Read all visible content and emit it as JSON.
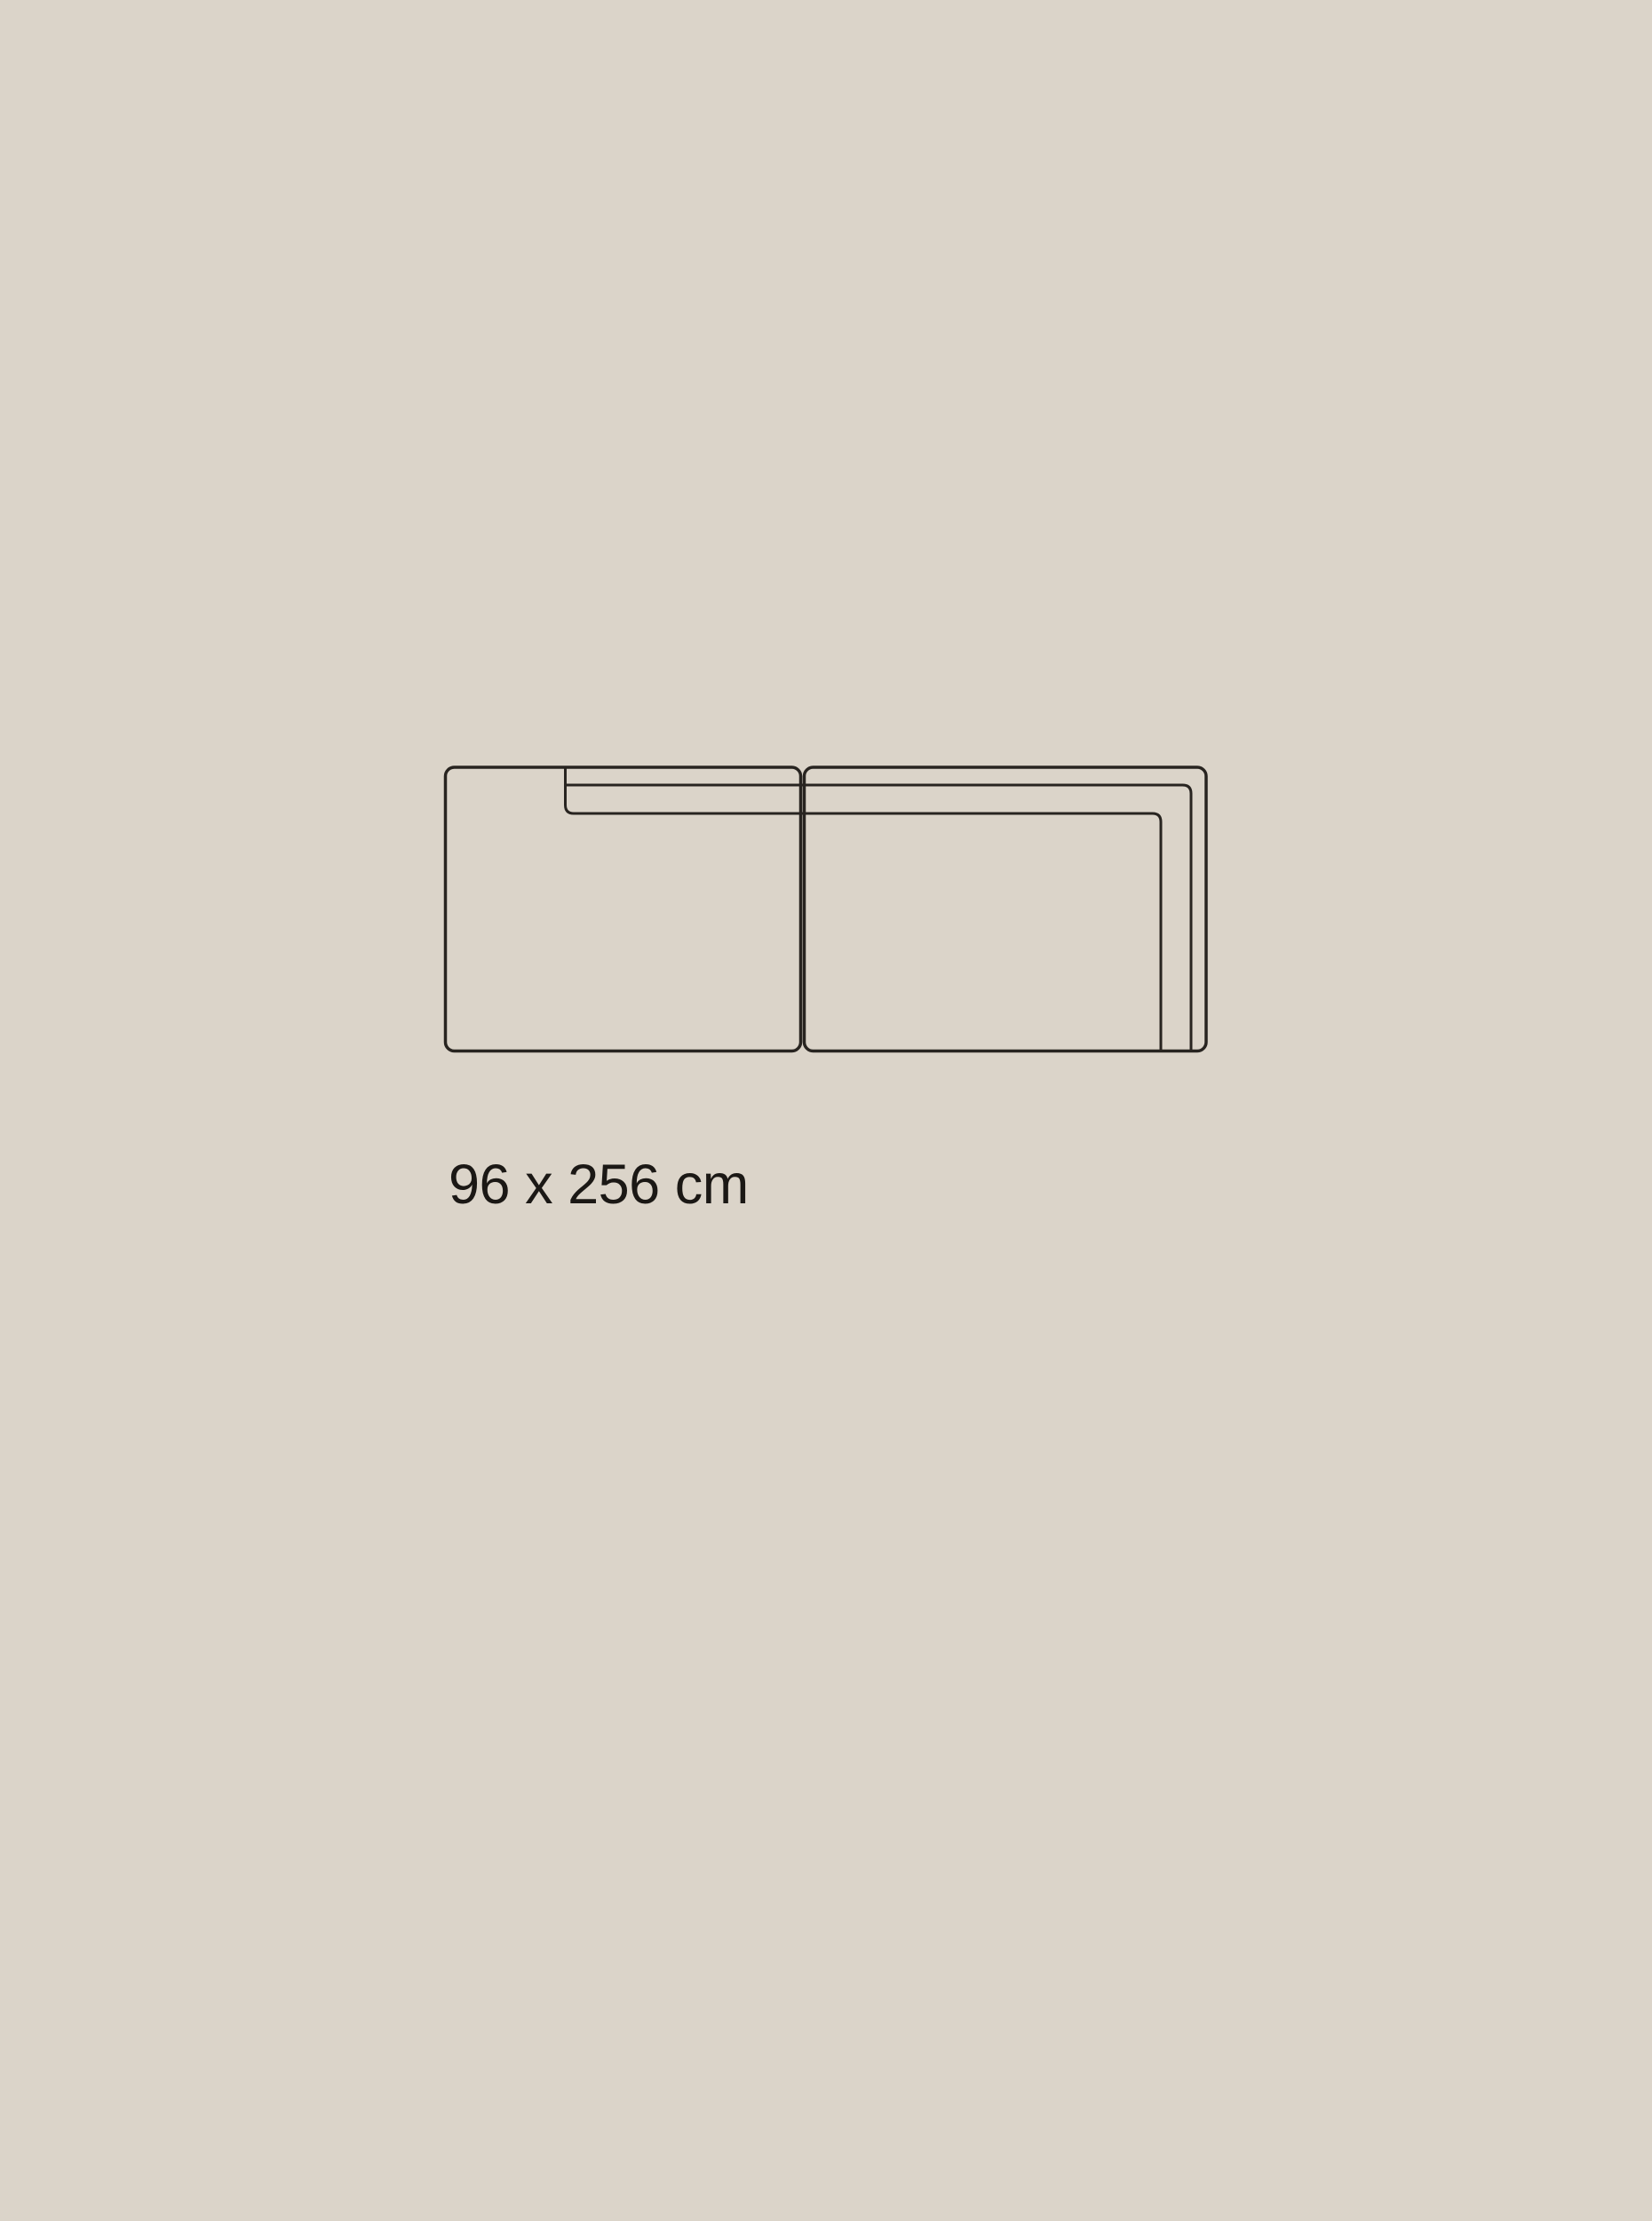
{
  "colors": {
    "background": "#DBD4C9",
    "line": "#282420",
    "text": "#1B1815"
  },
  "diagram": {
    "name": "two-module-sofa-top-view",
    "dimension_label": "96 x 256 cm"
  }
}
